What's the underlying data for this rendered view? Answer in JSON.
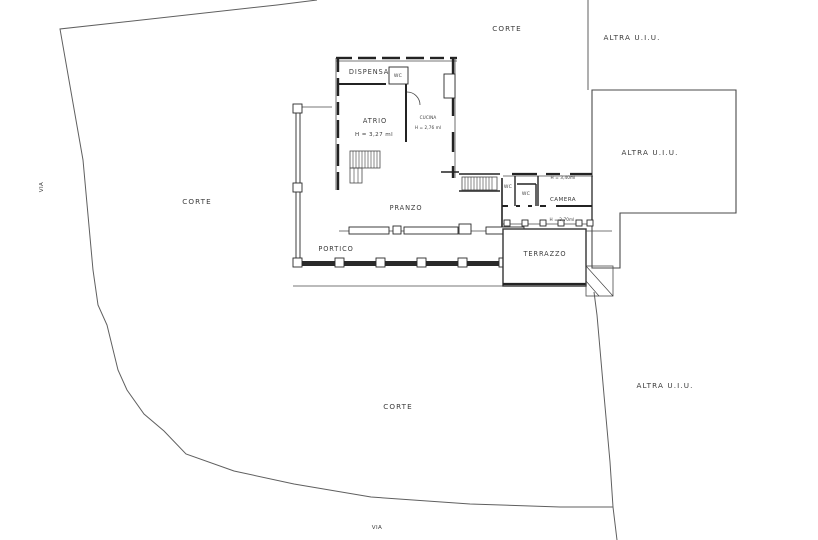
{
  "drawing": {
    "type": "cadastral-floor-plan",
    "background_color": "#ffffff",
    "line_color": "#3c3c3c",
    "text_color": "#3b3b3b"
  },
  "areas": {
    "corte_top": "CORTE",
    "corte_left": "CORTE",
    "corte_bottom": "CORTE",
    "altra_uiu_top": "ALTRA U.I.U.",
    "altra_uiu_building": "ALTRA U.I.U.",
    "altra_uiu_bottom": "ALTRA U.I.U.",
    "via_left": "VIA",
    "via_bottom": "VIA"
  },
  "rooms": {
    "dispensa": "DISPENSA",
    "wc_dispensa": "WC",
    "atrio": "ATRIO",
    "atrio_height": "H = 3,27 ml",
    "cucina": "CUCINA",
    "cucina_height": "H = 2,76 ml",
    "pranzo": "PRANZO",
    "portico": "PORTICO",
    "wc1": "WC",
    "wc2": "WC",
    "camera": "CAMERA",
    "camera_height": "H = 3,40ml",
    "loggia_height": "H = 2,70ml",
    "terrazzo": "TERRAZZO"
  }
}
